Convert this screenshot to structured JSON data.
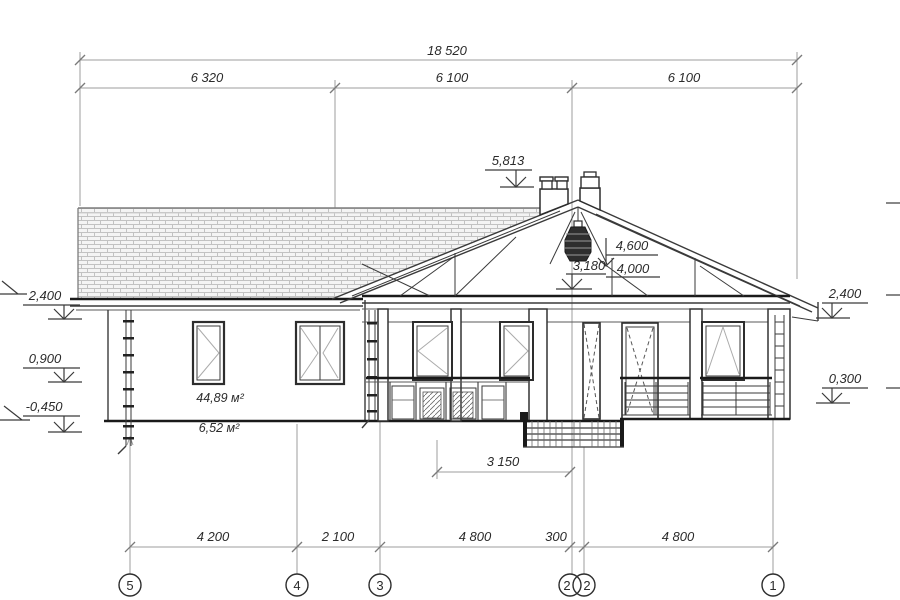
{
  "drawing": {
    "dims": {
      "overall": "18 520",
      "top": [
        "6 320",
        "6 100",
        "6 100"
      ],
      "bottom": [
        "4 200",
        "2 100",
        "4 800",
        "300",
        "4 800"
      ],
      "porch": "3 150"
    },
    "levels": {
      "left": [
        "2,400",
        "0,900",
        "-0,450"
      ],
      "right": [
        "2,400",
        "0,300"
      ],
      "chimney": "5,813",
      "ridge": "4,600",
      "collar": "4,000",
      "lamp": "3,180"
    },
    "areas": {
      "main": "44,89 м²",
      "porch": "6,52 м²"
    },
    "grid": [
      "5",
      "4",
      "3",
      "2",
      "2",
      "1"
    ],
    "colors": {
      "line": "#3a3a3a",
      "bold": "#1a1a1a",
      "dim_line": "#9c9c9c",
      "hatch": "#c2c2c2",
      "text": "#2b2b2b"
    }
  }
}
